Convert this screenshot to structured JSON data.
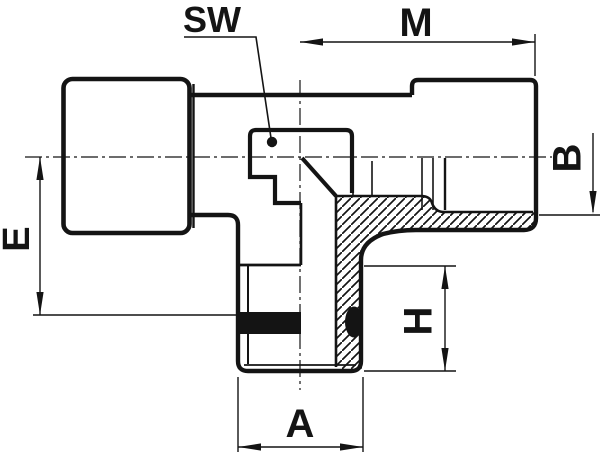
{
  "drawing": {
    "dimension_labels": {
      "sw": "SW",
      "m": "M",
      "b": "B",
      "e": "E",
      "h": "H",
      "a": "A"
    },
    "colors": {
      "line": "#141414",
      "background": "#ffffff",
      "seal": "#141414"
    }
  }
}
